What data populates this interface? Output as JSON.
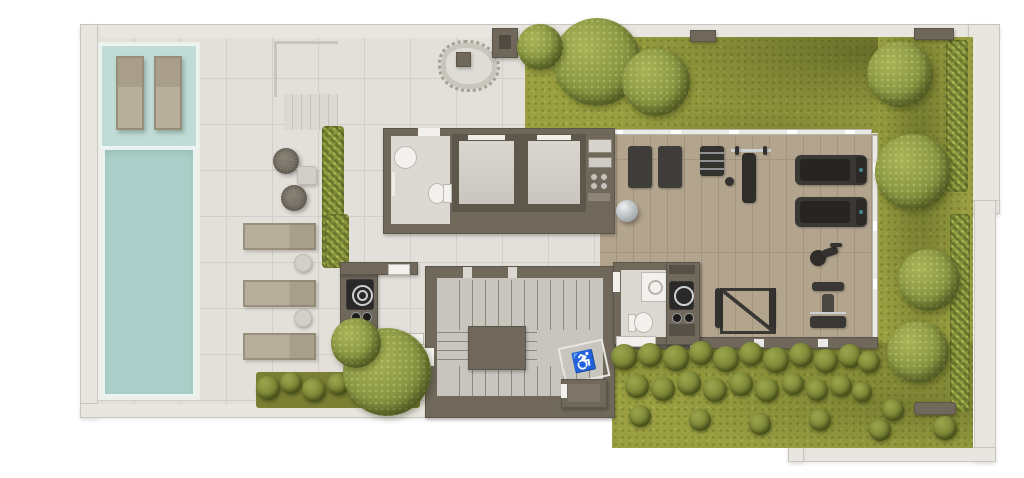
{
  "meta": {
    "type": "architectural-floor-plan",
    "view": "top-down-3d-render",
    "floor": "rooftop-amenities-level"
  },
  "colors": {
    "page": "#ffffff",
    "wall_outer": "#e9e6e1",
    "wall_outline": "#c9c6bf",
    "wall_core": "#6f685b",
    "wall_core_dark": "#5e574b",
    "deck": "#e3e0da",
    "tile_line": "#d2cfc8",
    "tile_interior": "#dcd9d2",
    "pool_ledge": "#c0dcd5",
    "pool_water": "#a9cfc8",
    "pool_rim": "#edefe9",
    "wood": "#b3a48e",
    "wood_line": "#a2937d",
    "stair_floor": "#c8c5bf",
    "stair_line": "#8d887e",
    "grass": "#9aa041",
    "grass_dark": "#757c30",
    "tree": "#8d9a45",
    "tree_dark": "#6d7730",
    "hedge": "#8f9c3f",
    "equipment": "#34322e",
    "metal": "#cdd1d3",
    "tan": "#b5ab99",
    "white_fix": "#f2f1ed",
    "screen_accent": "#49868c"
  },
  "symbols": {
    "accessible": "♿"
  },
  "areas": {
    "pool": "swimming-pool",
    "tanning_ledge": "tanning-ledge-with-in-water-loungers",
    "sun_deck": "tiled-sun-deck",
    "lounge_deck": "lounge-chair-deck",
    "elevators": 2,
    "bathroom_1": "accessible-bathroom",
    "bathroom_2": "bathroom-with-vanity",
    "stairwell": "u-shaped-stairwell",
    "accessible_area": "wheelchair-waiting-area",
    "barbecue_counters": 2,
    "gym": "fitness-room-wood-floor",
    "garden": "rooftop-garden",
    "water_feature": "tree-planter-with-gravel-border"
  },
  "gym_equipment": [
    "exercise-mat",
    "exercise-mat",
    "stability-ball",
    "dumbbell-rack",
    "bench-press",
    "treadmill",
    "treadmill",
    "spin-bike",
    "multi-gym",
    "squat-rack"
  ],
  "deck_furniture": [
    "pool-lounger",
    "pool-lounger",
    "pouf",
    "pouf",
    "square-side-table",
    "lounge-chair",
    "lounge-chair",
    "lounge-chair",
    "round-side-table",
    "round-side-table",
    "white-bench",
    "white-bench",
    "garden-bench"
  ],
  "garden": {
    "trees": [
      {
        "x": 597,
        "y": 62,
        "r": 44
      },
      {
        "x": 656,
        "y": 82,
        "r": 34
      },
      {
        "x": 540,
        "y": 47,
        "r": 23
      },
      {
        "x": 900,
        "y": 74,
        "r": 33
      },
      {
        "x": 913,
        "y": 172,
        "r": 38
      },
      {
        "x": 929,
        "y": 280,
        "r": 31
      },
      {
        "x": 918,
        "y": 352,
        "r": 31
      },
      {
        "x": 387,
        "y": 372,
        "r": 44
      },
      {
        "x": 356,
        "y": 343,
        "r": 25
      }
    ],
    "bushes": [
      {
        "x": 624,
        "y": 357,
        "r": 13
      },
      {
        "x": 650,
        "y": 355,
        "r": 12
      },
      {
        "x": 676,
        "y": 358,
        "r": 13
      },
      {
        "x": 701,
        "y": 353,
        "r": 12
      },
      {
        "x": 726,
        "y": 359,
        "r": 13
      },
      {
        "x": 751,
        "y": 354,
        "r": 12
      },
      {
        "x": 776,
        "y": 360,
        "r": 13
      },
      {
        "x": 801,
        "y": 355,
        "r": 12
      },
      {
        "x": 826,
        "y": 361,
        "r": 12
      },
      {
        "x": 850,
        "y": 356,
        "r": 12
      },
      {
        "x": 869,
        "y": 362,
        "r": 11
      },
      {
        "x": 637,
        "y": 386,
        "r": 12
      },
      {
        "x": 663,
        "y": 389,
        "r": 12
      },
      {
        "x": 689,
        "y": 383,
        "r": 12
      },
      {
        "x": 715,
        "y": 390,
        "r": 12
      },
      {
        "x": 741,
        "y": 384,
        "r": 12
      },
      {
        "x": 767,
        "y": 390,
        "r": 12
      },
      {
        "x": 793,
        "y": 384,
        "r": 11
      },
      {
        "x": 817,
        "y": 390,
        "r": 11
      },
      {
        "x": 841,
        "y": 386,
        "r": 11
      },
      {
        "x": 862,
        "y": 392,
        "r": 10
      },
      {
        "x": 268,
        "y": 388,
        "r": 12
      },
      {
        "x": 291,
        "y": 383,
        "r": 11
      },
      {
        "x": 314,
        "y": 390,
        "r": 12
      },
      {
        "x": 338,
        "y": 384,
        "r": 11
      },
      {
        "x": 362,
        "y": 391,
        "r": 12
      },
      {
        "x": 388,
        "y": 386,
        "r": 11
      },
      {
        "x": 410,
        "y": 391,
        "r": 10
      },
      {
        "x": 640,
        "y": 416,
        "r": 11
      },
      {
        "x": 700,
        "y": 420,
        "r": 11
      },
      {
        "x": 760,
        "y": 424,
        "r": 11
      },
      {
        "x": 820,
        "y": 420,
        "r": 11
      },
      {
        "x": 880,
        "y": 430,
        "r": 11
      },
      {
        "x": 945,
        "y": 428,
        "r": 12
      },
      {
        "x": 893,
        "y": 410,
        "r": 11
      }
    ]
  }
}
